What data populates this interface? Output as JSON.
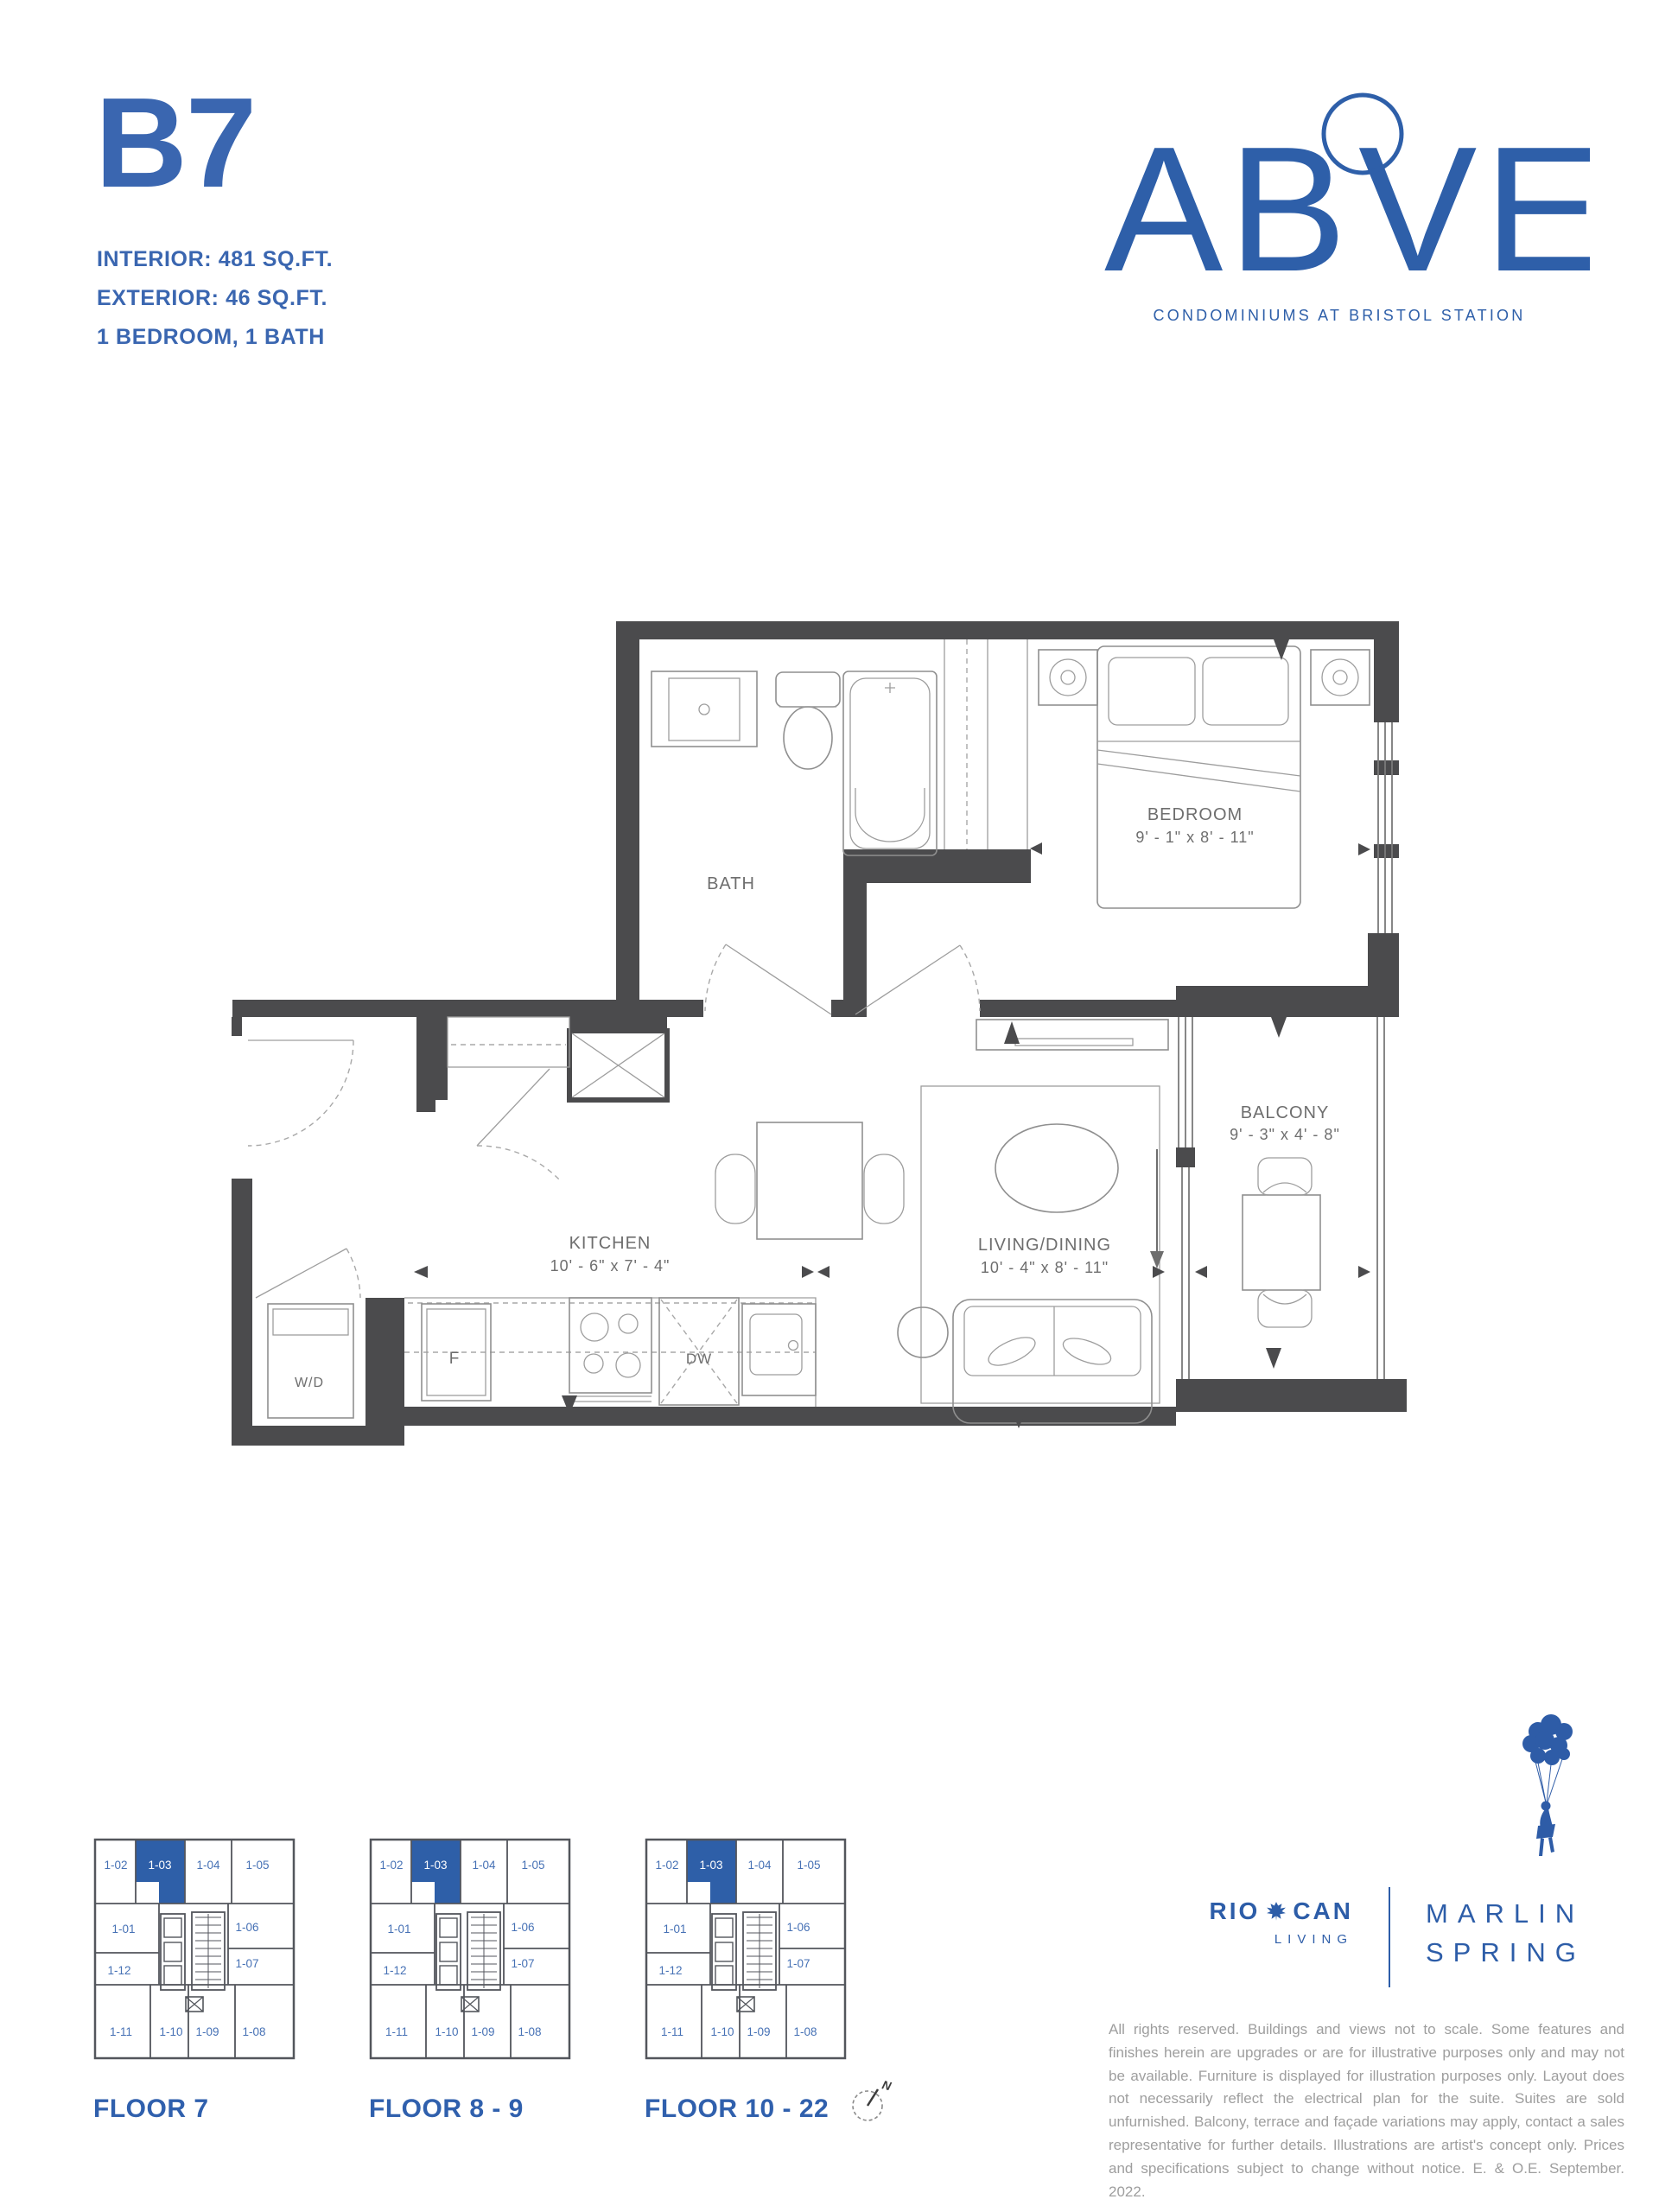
{
  "unit": {
    "name": "B7",
    "interior": "INTERIOR: 481 SQ.FT.",
    "exterior": "EXTERIOR: 46 SQ.FT.",
    "config": "1 BEDROOM, 1 BATH"
  },
  "brand": {
    "wordmark_left": "AB",
    "wordmark_right": "VE",
    "tagline": "CONDOMINIUMS AT BRISTOL STATION",
    "accent_color": "#2e5fa9"
  },
  "plan": {
    "bath": {
      "label": "BATH"
    },
    "bedroom": {
      "label": "BEDROOM",
      "dims": "9' - 1\" x 8' - 11\""
    },
    "kitchen": {
      "label": "KITCHEN",
      "dims": "10' - 6\" x 7' - 4\""
    },
    "living": {
      "label": "LIVING/DINING",
      "dims": "10' - 4\" x 8' - 11\""
    },
    "balcony": {
      "label": "BALCONY",
      "dims": "9' - 3\" x 4' - 8\""
    },
    "washer_dryer": {
      "label": "W/D"
    },
    "fridge": {
      "label": "F"
    },
    "dishwasher": {
      "label": "DW"
    },
    "wall_color": "#4b4b4d"
  },
  "floor_plates": {
    "highlighted_unit": "1-03",
    "highlight_color": "#2e5fa8",
    "units": [
      "1-02",
      "1-03",
      "1-04",
      "1-05",
      "1-01",
      "1-06",
      "1-12",
      "1-07",
      "1-11",
      "1-10",
      "1-09",
      "1-08"
    ],
    "floors": [
      {
        "label": "FLOOR 7"
      },
      {
        "label": "FLOOR 8 - 9"
      },
      {
        "label": "FLOOR 10 - 22"
      }
    ]
  },
  "compass": {
    "label": "N"
  },
  "footer": {
    "riocan_left": "RIO",
    "riocan_right": "CAN",
    "riocan_sub": "LIVING",
    "marlin_line1": "MARLIN",
    "marlin_line2": "SPRING",
    "logo_color": "#2d5da8",
    "disclaimer": "All rights reserved. Buildings and views not to scale. Some features and finishes herein are upgrades or are for illustrative purposes only and may not be available. Furniture is displayed for illustration purposes only. Layout does not necessarily reflect the electrical plan for the suite. Suites are sold unfurnished. Balcony, terrace and façade variations may apply, contact a sales representative for further details. Illustrations are artist's concept only. Prices and specifications subject to change without notice. E. & O.E. September. 2022."
  }
}
